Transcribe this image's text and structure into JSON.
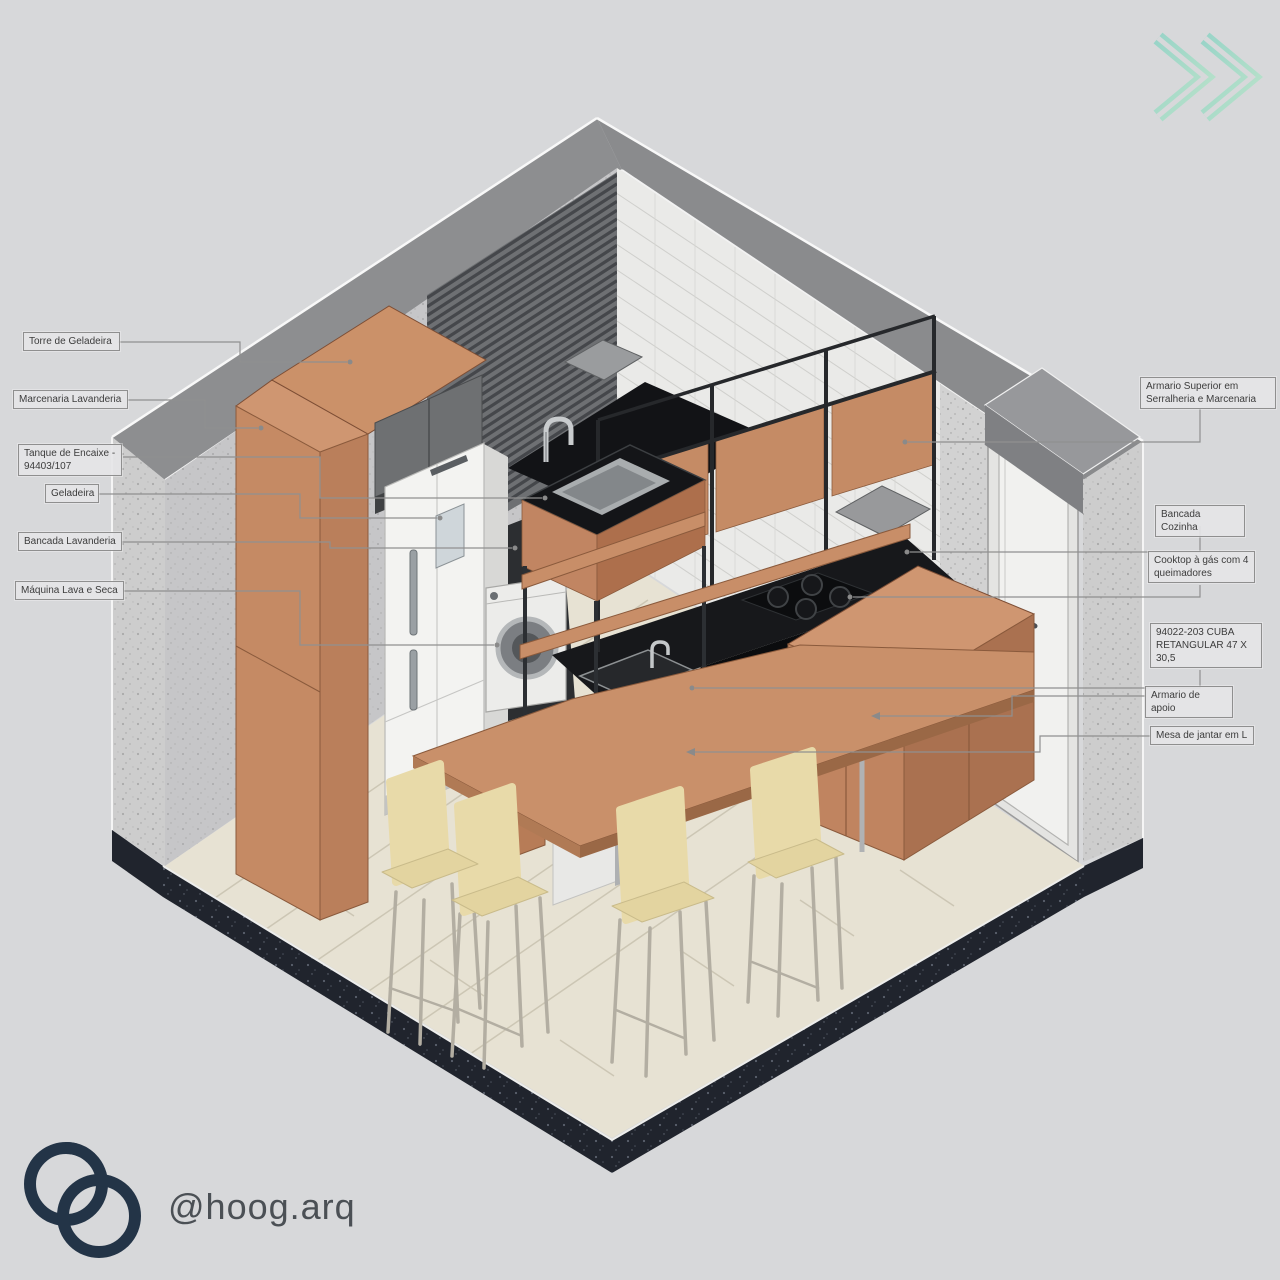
{
  "branding": {
    "handle": "@hoog.arq",
    "logo_icon": "interlocking-circles-logo",
    "next_icon": "double-chevron-right-icon"
  },
  "colors": {
    "background": "#d7d8da",
    "terracotta_wood": "#c38563",
    "counter_black": "#17181b",
    "steel_frame": "#2c2f33",
    "chair_beige": "#e8daa9",
    "floor_tile": "#e7e2d3",
    "wall_cap_gray": "#8d8e90",
    "plinth_dark": "#20242d",
    "teal_accent": "#8fd4c5",
    "logo_navy": "#233447"
  },
  "annotations": {
    "left": [
      {
        "text": "Torre de Geladeira"
      },
      {
        "text": "Marcenaria Lavanderia"
      },
      {
        "text": "Tanque de Encaixe - 94403/107"
      },
      {
        "text": "Geladeira"
      },
      {
        "text": "Bancada Lavanderia"
      },
      {
        "text": "Máquina Lava e Seca"
      }
    ],
    "right": [
      {
        "text": "Armario Superior em Serralheria e Marcenaria"
      },
      {
        "text": "Bancada Cozinha"
      },
      {
        "text": "Cooktop à gás com 4 queimadores"
      },
      {
        "text": "94022-203 CUBA RETANGULAR 47 X 30,5"
      },
      {
        "text": "Armario de apoio"
      },
      {
        "text": "Mesa de jantar em L"
      }
    ]
  }
}
